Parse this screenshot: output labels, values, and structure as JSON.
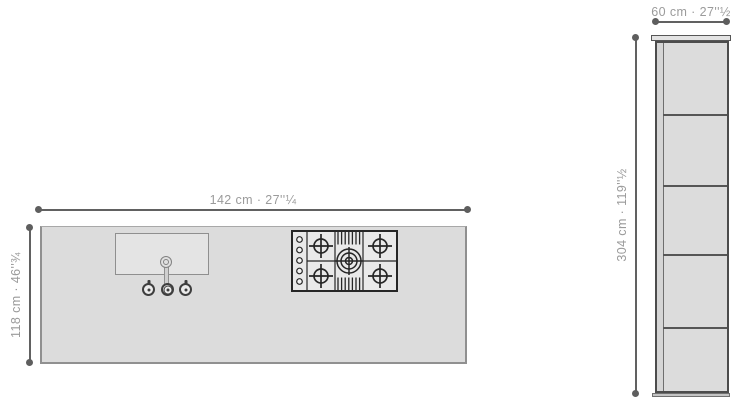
{
  "labels": {
    "island_width": "142 cm · 27''¼",
    "island_depth": "118 cm · 46''¾",
    "cabinet_width": "60 cm · 27''½",
    "cabinet_height": "304 cm · 119''½"
  },
  "island": {
    "sink": {
      "control_count": 3,
      "has_faucet": true
    },
    "cooktop": {
      "burner_count": 5,
      "knob_count": 5
    }
  },
  "cabinet": {
    "door_count": 5
  },
  "colors": {
    "surface_fill": "#dcdcdc",
    "outline": "#4c4c4c",
    "dimension_line": "#5e5e5e",
    "label_text": "#9b9b9b",
    "cooktop_line": "#262626",
    "background": "#ffffff"
  }
}
